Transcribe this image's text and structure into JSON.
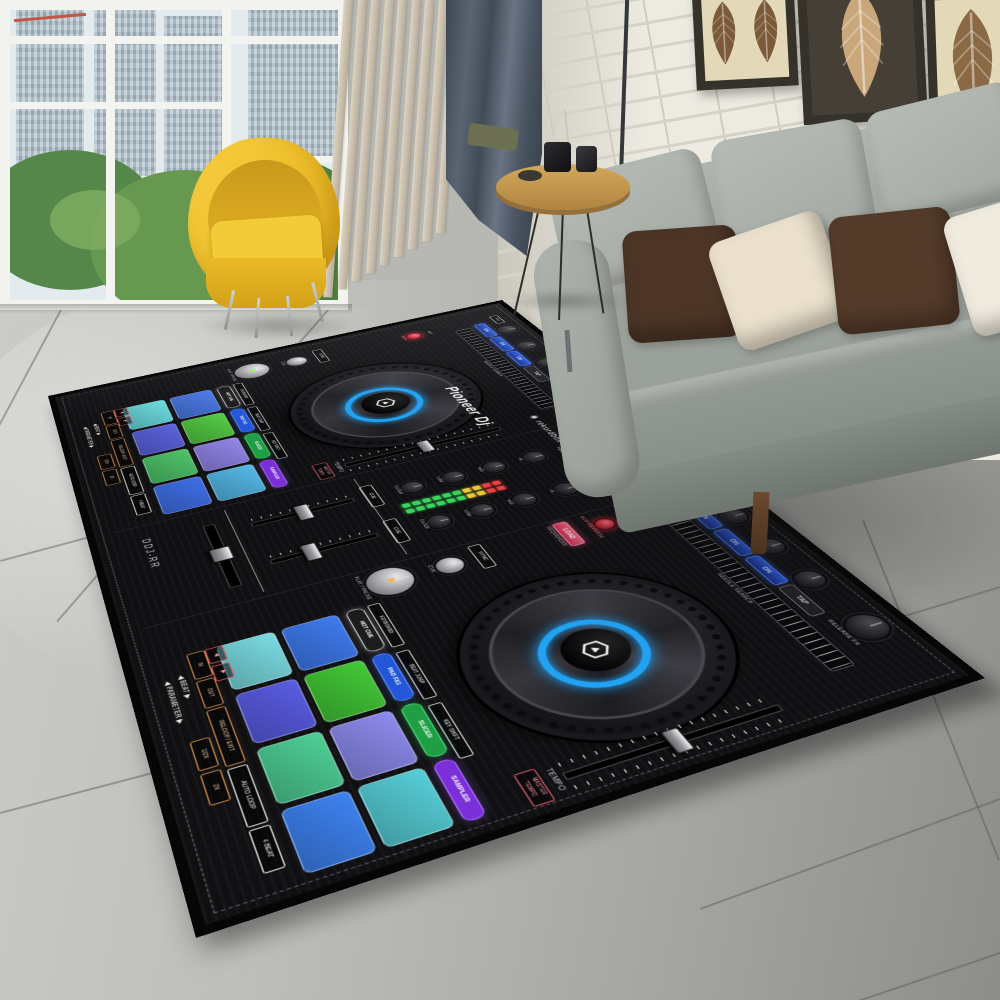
{
  "rug": {
    "base_color": "#101013",
    "binding_color": "#060607",
    "controller": {
      "brand": "Pioneer Dj",
      "software": "rekordbox",
      "model": "DDJ-RR",
      "jog_ring_color": "#22a2f2",
      "fx_buttons": [
        "ON",
        "ON",
        "ON",
        "TAP"
      ],
      "pad_modes": [
        {
          "label": "HOT CUE",
          "bg": "#1c1c1f",
          "border": "#cfcfcf"
        },
        {
          "label": "PAD FX1",
          "bg": "#2456d8",
          "border": "#5b8bff"
        },
        {
          "label": "SLICER",
          "bg": "#1f9e44",
          "border": "#46d878"
        },
        {
          "label": "SAMPLER",
          "bg": "#7a2fd8",
          "border": "#a86bff"
        }
      ],
      "pad_sub_labels": [
        "KEYBOARD",
        "BEAT JUMP",
        "KEY SHIFT"
      ],
      "loop_buttons": [
        "IN",
        "OUT",
        "RELOOP / EXIT",
        "AUTO LOOP",
        "4 BEAT"
      ],
      "beat_buttons": [
        "1/2X",
        "2X"
      ],
      "adjust_labels": [
        "◀ BEAT ▶",
        "◀ PARAMETER ▶"
      ],
      "labels": {
        "needle": "NEEDLE SEARCH",
        "tempo": "TEMPO",
        "master_tempo": "MASTER TEMPO",
        "release_fx": "RELEASE FX",
        "rev": "REV",
        "sync": "SYNC",
        "cue": "CUE",
        "play": "PLAY / PAUSE",
        "load": "LOAD",
        "sequencer": "SEQUENCER",
        "slip": "SLIP",
        "slip_reverse": "SLIP REVERSE",
        "sound_color_fx": "SOUND COLOR FX"
      },
      "mixer": {
        "knobs": [
          "TRIM",
          "HI",
          "MID",
          "LOW",
          "FILTER"
        ],
        "headphone": "CUE",
        "vu": {
          "green": 6,
          "amber": 2,
          "red": 2
        },
        "vu_colors": {
          "green": "#3ad45c",
          "amber": "#e8c83a",
          "red": "#ee4040"
        }
      },
      "decks": [
        {
          "name": "deck-1",
          "fx_label": "FX1",
          "pads_top": [
            "#4a7ae8",
            "#55cc44",
            "#9386ea",
            "#55b9e8"
          ],
          "pads_bottom": [
            "#6adce0",
            "#5c63e0",
            "#4ec56a",
            "#3f6fe8"
          ]
        },
        {
          "name": "deck-2",
          "fx_label": "FX2",
          "pads_top": [
            "#3f7bf0",
            "#43c937",
            "#8d8bee",
            "#57cfd8"
          ],
          "pads_bottom": [
            "#7adce2",
            "#5a5ce4",
            "#4ecf96",
            "#3e83f2"
          ]
        }
      ]
    }
  },
  "room": {
    "sofa": {
      "body": "#a3a8a2",
      "pillows": [
        "#4c3526",
        "#eae0cc",
        "#543b2a",
        "#f0ebdf",
        "#4e3828"
      ],
      "back_cushions": 4
    },
    "chair": {
      "shell": "#efc02c"
    },
    "curtain_color": "#4a5462",
    "slat_color": "#d6ccba",
    "slat_count": 9,
    "brick": {
      "base": "#edebe1",
      "mortar": "#d5d2c7"
    },
    "window": {
      "sky": "#e4ebee",
      "towers": "#a3b6c2",
      "foliage": "#5f9150"
    },
    "floor": {
      "light": "#c9cac5",
      "dark": "#8e8f8b"
    },
    "table_top": "#c89a50",
    "art": [
      {
        "bg": "#e3d8b8",
        "leaf": "#7a5a38",
        "frame": "#35322c",
        "panels": 2
      },
      {
        "bg": "#463f35",
        "leaf": "#c9a77a",
        "frame": "#35322c",
        "panels": 1
      },
      {
        "bg": "#e3d8b8",
        "leaf": "#8a6a44",
        "frame": "#35322c",
        "panels": 1
      }
    ]
  }
}
